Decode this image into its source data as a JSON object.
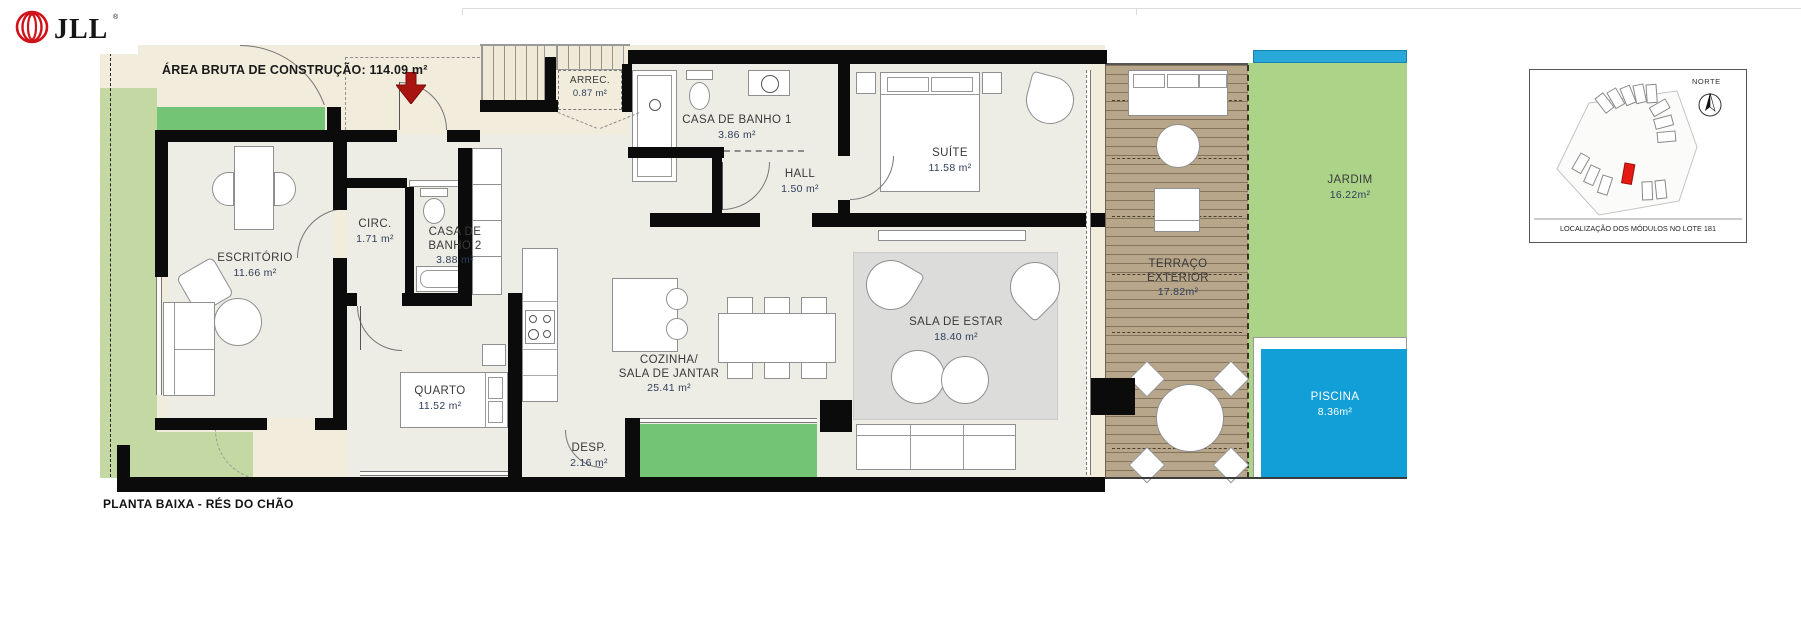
{
  "brand": {
    "logo_text": "JLL",
    "registered_mark": "®"
  },
  "plan": {
    "gross_area_label": "ÁREA BRUTA DE CONSTRUÇÃO: 114.09 m²",
    "drawing_title": "PLANTA BAIXA - RÉS DO CHÃO",
    "rooms": [
      {
        "name": "ESCRITÓRIO",
        "area": "11.66 m²"
      },
      {
        "name": "CIRC.",
        "area": "1.71 m²"
      },
      {
        "name": "CASA DE\nBANHO 2",
        "area": "3.88 m²"
      },
      {
        "name": "QUARTO",
        "area": "11.52 m²"
      },
      {
        "name": "ARREC.",
        "area": "0.87 m²"
      },
      {
        "name": "CASA DE BANHO 1",
        "area": "3.86 m²"
      },
      {
        "name": "HALL",
        "area": "1.50 m²"
      },
      {
        "name": "SUÍTE",
        "area": "11.58 m²"
      },
      {
        "name": "COZINHA/\nSALA DE JANTAR",
        "area": "25.41 m²"
      },
      {
        "name": "SALA DE ESTAR",
        "area": "18.40 m²"
      },
      {
        "name": "DESP.",
        "area": "2.16 m²"
      },
      {
        "name": "TERRAÇO\nEXTERIOR",
        "area": "17.82m²"
      },
      {
        "name": "JARDIM",
        "area": "16.22m²"
      },
      {
        "name": "PISCINA",
        "area": "8.36m²"
      }
    ]
  },
  "locator": {
    "north_label": "NORTE",
    "caption": "LOCALIZAÇÃO DOS MÓDULOS NO LOTE 181"
  },
  "colors": {
    "pool_blue": "#129fd8",
    "garden_green": "#abd489",
    "lawn_green": "#74c476",
    "band_green": "#c3d8a2",
    "deck_tan": "#b7a68a",
    "exterior_beige": "#f1ecdc",
    "interior_floor": "#edece5",
    "entry_arrow_red": "#a81410",
    "brand_red": "#d0121b"
  }
}
